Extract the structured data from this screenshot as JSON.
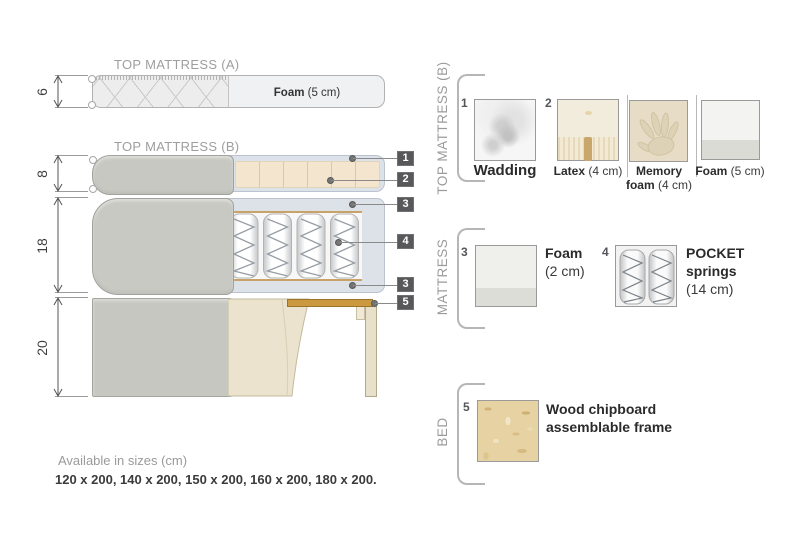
{
  "left": {
    "top_mattress_a": {
      "title": "TOP MATTRESS (A)",
      "dim": "6",
      "foam_bold": "Foam",
      "foam_rest": " (5 cm)"
    },
    "top_mattress_b": {
      "title": "TOP MATTRESS (B)",
      "dim": "8"
    },
    "mattress": {
      "dim": "18"
    },
    "bed": {
      "dim": "20"
    },
    "callouts": {
      "c1": "1",
      "c2": "2",
      "c3": "3",
      "c4": "4",
      "c3b": "3",
      "c5": "5"
    }
  },
  "right": {
    "section_top": {
      "label": "TOP MATTRESS (B)",
      "item1": {
        "num": "1",
        "name": "Wadding"
      },
      "item2": {
        "num": "2",
        "name_bold": "Latex",
        "name_rest": " (4 cm)"
      },
      "item3": {
        "line1": "Memory",
        "line2_bold": "foam",
        "line2_rest": " (4 cm)"
      },
      "item4": {
        "name_bold": "Foam",
        "name_rest": " (5 cm)"
      }
    },
    "section_mid": {
      "label": "MATTRESS",
      "item3": {
        "num": "3",
        "line1": "Foam",
        "line2": "(2 cm)"
      },
      "item4": {
        "num": "4",
        "line1": "POCKET",
        "line2": "springs",
        "line3": "(14 cm)"
      }
    },
    "section_bed": {
      "label": "BED",
      "item5": {
        "num": "5",
        "line1": "Wood chipboard",
        "line2": "assemblable frame"
      }
    }
  },
  "footer": {
    "title": "Available in sizes (cm)",
    "sizes": "120 x 200, 140 x 200, 150 x 200, 160 x 200, 180 x 200."
  },
  "colors": {
    "callout_box": "#58585a",
    "gray_fabric": "#c8c8c2",
    "wadding_blue": "#dde2e9",
    "foam_beige": "#f4e6ce",
    "wood_plank": "#ca9940",
    "chipboard": "#e6d2a2"
  }
}
